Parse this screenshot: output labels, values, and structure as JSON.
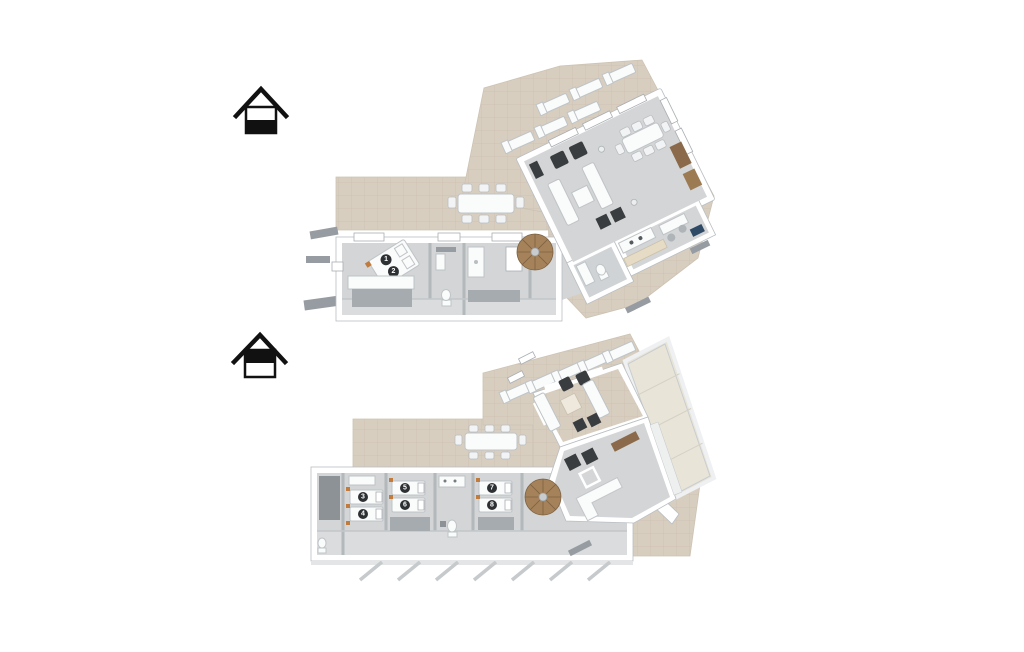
{
  "colors": {
    "background": "#ffffff",
    "terrace-tile": "#d8cec0",
    "terrace-grout": "#c8bcab",
    "floor": "#d3d5d6",
    "wall": "#ffffff",
    "furniture-dark": "#3a3d3f",
    "furniture-white": "#fafbfb",
    "wood": "#9c7a52",
    "glass-roof": "#e8e4d8",
    "icon-black": "#111111",
    "hatch": "#c6cacc",
    "accent-orange": "#c07b3d",
    "shelf-navy": "#2f4a66"
  },
  "floor_selector": {
    "ground": {
      "icon": "house-lower-half-filled"
    },
    "upper": {
      "icon": "house-upper-half-filled"
    }
  },
  "plans": {
    "ground_floor": {
      "bed_numbers": [
        "1",
        "2"
      ]
    },
    "first_floor": {
      "bed_numbers": [
        "3",
        "4",
        "5",
        "6",
        "7",
        "8"
      ]
    }
  }
}
